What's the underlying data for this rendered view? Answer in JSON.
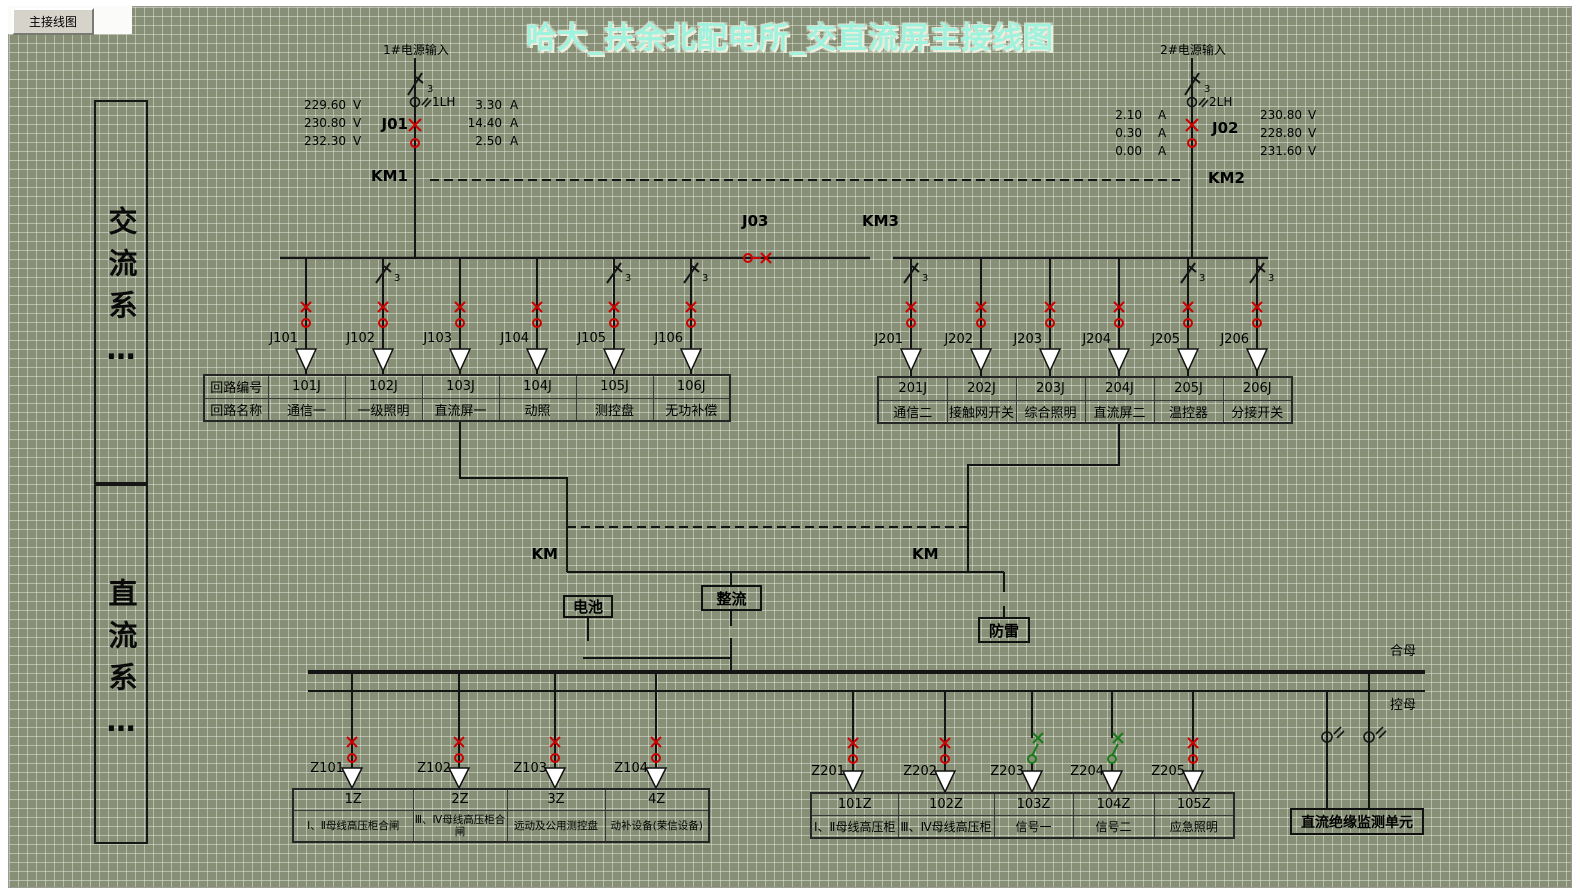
{
  "chrome": {
    "tab": "主接线图"
  },
  "title": "哈大_扶余北配电所_交直流屏主接线图",
  "phase_count_label": "3",
  "sidebar": {
    "ac": "交流系…",
    "dc": "直流系…"
  },
  "sources": {
    "s1": {
      "label": "1#电源输入",
      "ct": "1LH",
      "breaker": "J01",
      "km": "KM1",
      "meas_left": [
        {
          "v": "229.60",
          "u": "V"
        },
        {
          "v": "230.80",
          "u": "V"
        },
        {
          "v": "232.30",
          "u": "V"
        }
      ],
      "meas_right": [
        {
          "v": "3.30",
          "u": "A"
        },
        {
          "v": "14.40",
          "u": "A"
        },
        {
          "v": "2.50",
          "u": "A"
        }
      ]
    },
    "s2": {
      "label": "2#电源输入",
      "ct": "2LH",
      "breaker": "J02",
      "km": "KM2",
      "meas_left": [
        {
          "v": "2.10",
          "u": "A"
        },
        {
          "v": "0.30",
          "u": "A"
        },
        {
          "v": "0.00",
          "u": "A"
        }
      ],
      "meas_right": [
        {
          "v": "230.80",
          "u": "V"
        },
        {
          "v": "228.80",
          "u": "V"
        },
        {
          "v": "231.60",
          "u": "V"
        }
      ]
    }
  },
  "tie": {
    "breaker": "J03",
    "km": "KM3"
  },
  "ac_table_left": {
    "header_row1": "回路编号",
    "header_row2": "回路名称",
    "feeders": [
      {
        "sw": "J101",
        "code": "101J",
        "name": "通信一"
      },
      {
        "sw": "J102",
        "code": "102J",
        "name": "一级照明"
      },
      {
        "sw": "J103",
        "code": "103J",
        "name": "直流屏一"
      },
      {
        "sw": "J104",
        "code": "104J",
        "name": "动照"
      },
      {
        "sw": "J105",
        "code": "105J",
        "name": "测控盘"
      },
      {
        "sw": "J106",
        "code": "106J",
        "name": "无功补偿"
      }
    ]
  },
  "ac_table_right": {
    "feeders": [
      {
        "sw": "J201",
        "code": "201J",
        "name": "通信二"
      },
      {
        "sw": "J202",
        "code": "202J",
        "name": "接触网开关"
      },
      {
        "sw": "J203",
        "code": "203J",
        "name": "综合照明"
      },
      {
        "sw": "J204",
        "code": "204J",
        "name": "直流屏二"
      },
      {
        "sw": "J205",
        "code": "205J",
        "name": "温控器"
      },
      {
        "sw": "J206",
        "code": "206J",
        "name": "分接开关"
      }
    ]
  },
  "dc": {
    "km_left": "KM",
    "km_right": "KM",
    "battery": "电池",
    "rectifier": "整流",
    "arrester": "防雷",
    "bus_top": "合母",
    "bus_bottom": "控母",
    "monitor": "直流绝缘监测单元"
  },
  "dc_table_left": {
    "feeders": [
      {
        "sw": "Z101",
        "code": "1Z",
        "name": "Ⅰ、Ⅱ母线高压柜合闸"
      },
      {
        "sw": "Z102",
        "code": "2Z",
        "name": "Ⅲ、Ⅳ母线高压柜合闸"
      },
      {
        "sw": "Z103",
        "code": "3Z",
        "name": "远动及公用测控盘"
      },
      {
        "sw": "Z104",
        "code": "4Z",
        "name": "动补设备(荣信设备)"
      }
    ]
  },
  "dc_table_right": {
    "feeders": [
      {
        "sw": "Z201",
        "code": "101Z",
        "name": "Ⅰ、Ⅱ母线高压柜"
      },
      {
        "sw": "Z202",
        "code": "102Z",
        "name": "Ⅲ、Ⅳ母线高压柜"
      },
      {
        "sw": "Z203",
        "code": "103Z",
        "name": "信号一"
      },
      {
        "sw": "Z204",
        "code": "104Z",
        "name": "信号二"
      },
      {
        "sw": "Z205",
        "code": "105Z",
        "name": "应急照明"
      }
    ]
  },
  "colors": {
    "closed_breaker": "#cc0000",
    "open_breaker": "#1b7a1b",
    "title": "#9ff2de"
  }
}
